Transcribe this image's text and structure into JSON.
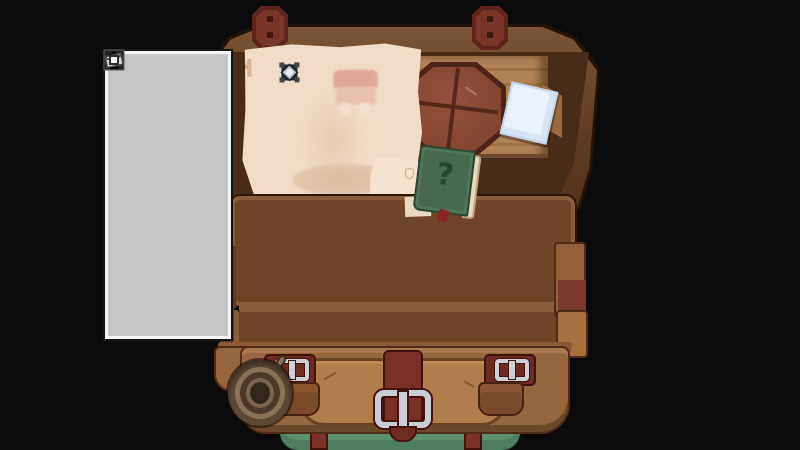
{
  "scene": {
    "label": "open traveler's chest inventory",
    "background_color": "#0b0b0c"
  },
  "equipment_panel": {
    "frame_color": "#c6c6c6",
    "slot_color": "#9e9e9e",
    "icon_outline_color": "#6f6f6f",
    "pin_color": "#f2f2f2",
    "grid": {
      "columns": 3,
      "rows": 8
    },
    "slots": [
      {
        "icon": "helmet-icon",
        "filled": false
      },
      {
        "icon": "amulet-icon",
        "filled": false
      },
      {
        "icon": "satchel-icon",
        "filled": false
      },
      {
        "icon": "shirt-icon",
        "filled": false
      },
      {
        "icon": "cloak-icon",
        "filled": false
      },
      {
        "icon": "cloak-icon",
        "filled": false
      },
      {
        "icon": "ring-icon",
        "filled": false
      },
      {
        "icon": "ring-icon",
        "filled": false
      },
      {
        "icon": "belt-icon",
        "filled": false
      },
      {
        "icon": "boot-icon",
        "filled": false
      },
      {
        "icon": "boot-icon",
        "filled": false
      },
      {
        "icon": "flask-icon",
        "filled": false
      },
      {
        "icon": "flask-icon",
        "filled": false
      },
      {
        "icon": "pouch-icon",
        "filled": false
      },
      {
        "icon": "pouch-icon",
        "filled": false
      },
      {
        "icon": "coil-icon",
        "filled": false
      },
      {
        "icon": "coil-icon",
        "filled": false
      },
      {
        "icon": "coil-icon",
        "filled": false
      },
      {
        "icon": "coil-icon",
        "filled": false
      },
      {
        "icon": "sack-item-icon",
        "filled": true
      },
      {
        "icon": "sack-item-icon",
        "filled": true
      },
      {
        "icon": "bag-icon",
        "filled": false
      },
      {
        "icon": "totem-item-icon",
        "filled": true
      },
      {
        "icon": "map-item-icon",
        "filled": true
      }
    ]
  },
  "chest": {
    "hinge_count": 2,
    "tray": {
      "columns": 9,
      "rows": 3,
      "slot_color": "#2b150c",
      "frame_color": "#8a5c3a"
    },
    "bottom_compartment": {
      "columns": 9,
      "visible_rows": 1,
      "slot_color": "#2b150c"
    },
    "front": {
      "strap_color": "#7a3026",
      "buckle_color": "#c9ced6",
      "canvas_color": "#5d8e70"
    }
  },
  "parchment": {
    "color": "#f0dcc8",
    "slots": [
      {
        "icon": "gem-mini-icon"
      },
      {
        "icon": "cloak-mini-icon"
      },
      {
        "icon": "lantern-mini-icon"
      },
      {
        "icon": "blank-mini-icon"
      },
      {
        "icon": "hook-mini-icon"
      }
    ],
    "items": [
      {
        "icon": "socket-gem-icon"
      }
    ],
    "torn_note_icon": "shield-mini-icon"
  },
  "desk": {
    "round_table_color": "#8a4532",
    "paper_color": "#e9f1fb"
  },
  "book": {
    "label": "?",
    "cover_color": "#45684e"
  }
}
